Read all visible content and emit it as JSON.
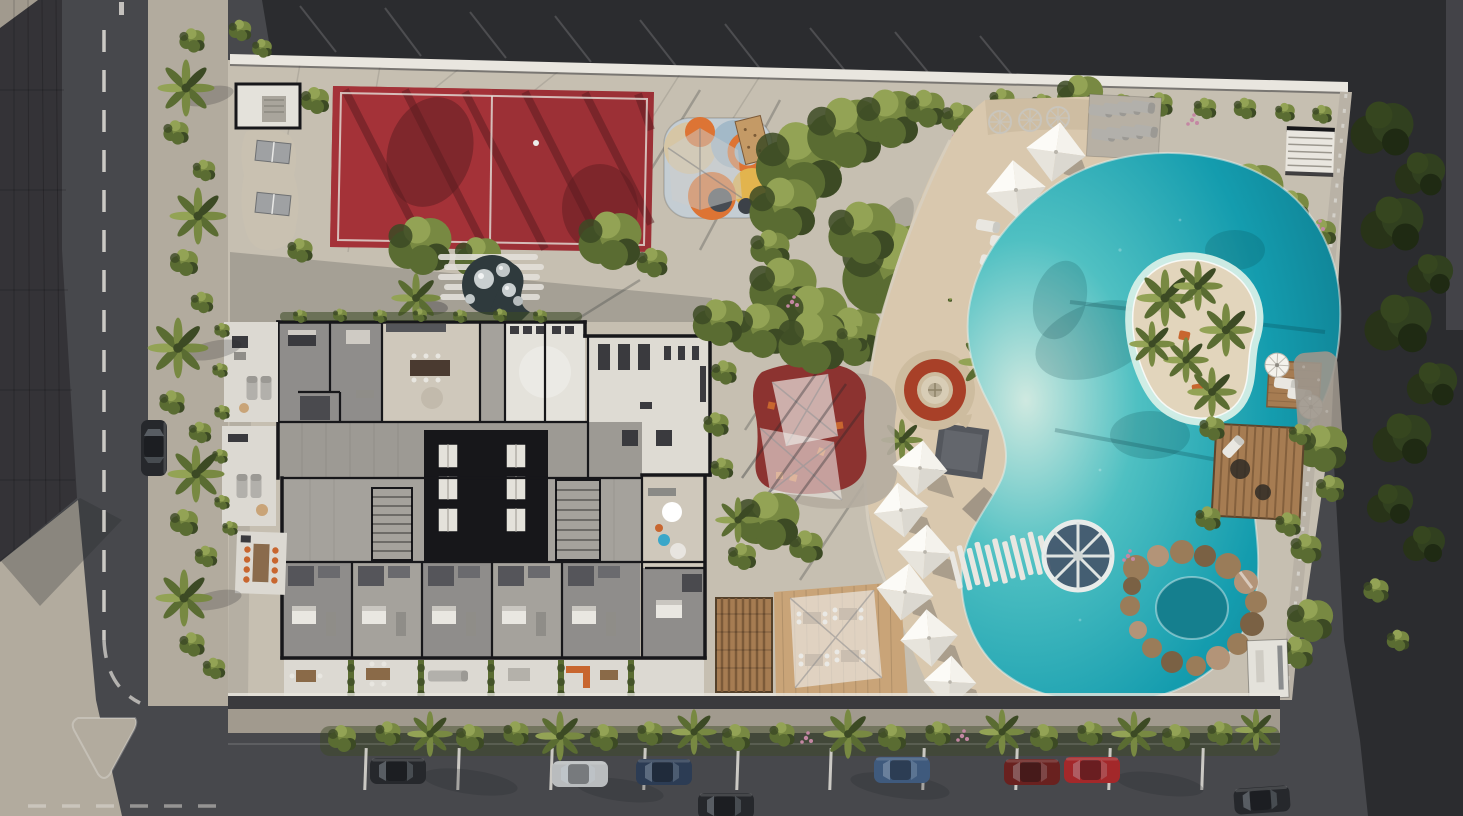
{
  "meta": {
    "type": "aerial-architectural-rendering",
    "subject": "top-down site plan render of a residential resort block with lagoon pool, padel court, playground, gardens and street parking",
    "width": 1463,
    "height": 816
  },
  "colors": {
    "asphalt": "#47484c",
    "asphalt_dark": "#2b2c2f",
    "roof_dark": "#343337",
    "pavement": "#c6bfb1",
    "pavement_shade": "#a19a8e",
    "sidewalk": "#b2ab9e",
    "curb_white": "#d8d6d0",
    "wall_white": "#e9e6df",
    "court_red": "#9c3036",
    "court_red_deep": "#7c2428",
    "court_shadow": "#5a1b20",
    "line_white": "#e3e0da",
    "mural_base": "#c4cdd3",
    "mural_beige": "#d6c6a5",
    "mural_blue": "#a3b9c8",
    "mural_orange": "#dd7434",
    "mural_yellow": "#e2b44e",
    "mural_dark": "#474c53",
    "green_dark": "#3c4a24",
    "green_mid": "#5a6c32",
    "green_light": "#788942",
    "green_bright": "#93a355",
    "green_deep": "#283318",
    "flower_pink": "#c487a3",
    "sand": "#d9c8ae",
    "sand_shade": "#c3b195",
    "pool_light": "#cfe9e0",
    "pool_mid": "#4fc0c2",
    "pool_deep": "#149cae",
    "pool_shadow": "#0d7285",
    "island_sand": "#e2d5bc",
    "spa_water": "#157f8e",
    "rock": "#9a7c59",
    "rock_dark": "#7a6144",
    "rock_light": "#b39478",
    "wood": "#a67c52",
    "wood_dark": "#7c5a39",
    "deck_tan": "#c9a478",
    "canopy_gray": "#54575d",
    "fire_ring": "#a84028",
    "fire_center": "#d8cdb6",
    "umbrella_white": "#f4f2ec",
    "umbrella_shade": "#dbd8d0",
    "umbrella_mid": "#e7e4dc",
    "umbrella_top": "#fcfbf7",
    "lounger_white": "#e9e7e1",
    "lounger_gray": "#b2b0ab",
    "building_wall": "#17171a",
    "floor_gray": "#8f8d8b",
    "floor_mid": "#a5a29c",
    "floor_tile": "#9d9a94",
    "floor_light": "#cfc8bb",
    "floor_bright": "#e4e2db",
    "terrace_white": "#dcd9d2",
    "furn_dark": "#3a3a3e",
    "accent_orange": "#c8662f",
    "accent_teal": "#3aa7c9",
    "wheel_center": "#44566b",
    "car_dark": "#26282c",
    "car_silver": "#b9bcbe",
    "car_navy": "#2c3c54",
    "car_blue": "#3f5a7d",
    "car_maroon": "#69211f",
    "car_red": "#a3282a",
    "shadow": "#23262a"
  },
  "scene": {
    "areas": [
      {
        "name": "padel-court"
      },
      {
        "name": "kids-playground-mural"
      },
      {
        "name": "toddler-play-area"
      },
      {
        "name": "sensory-garden"
      },
      {
        "name": "fire-pit-lounge"
      },
      {
        "name": "beach-sand-lounge"
      },
      {
        "name": "lagoon-pool"
      },
      {
        "name": "palm-island"
      },
      {
        "name": "water-wheel-feature"
      },
      {
        "name": "rock-grotto-spa"
      },
      {
        "name": "pergola-cabana"
      },
      {
        "name": "outdoor-dining-deck"
      },
      {
        "name": "timber-pergola"
      },
      {
        "name": "residential-floor-plan"
      },
      {
        "name": "gym"
      },
      {
        "name": "elevator-core"
      },
      {
        "name": "private-terraces"
      },
      {
        "name": "street-parking"
      },
      {
        "name": "perimeter-streets"
      }
    ],
    "counts": {
      "pyramid_umbrellas": 8,
      "round_umbrellas": 7,
      "parked_cars": 8,
      "elevators": 6,
      "pool_islands": 1
    },
    "vehicle_colors": [
      "dark-gray",
      "silver",
      "navy",
      "blue",
      "maroon",
      "red"
    ]
  }
}
